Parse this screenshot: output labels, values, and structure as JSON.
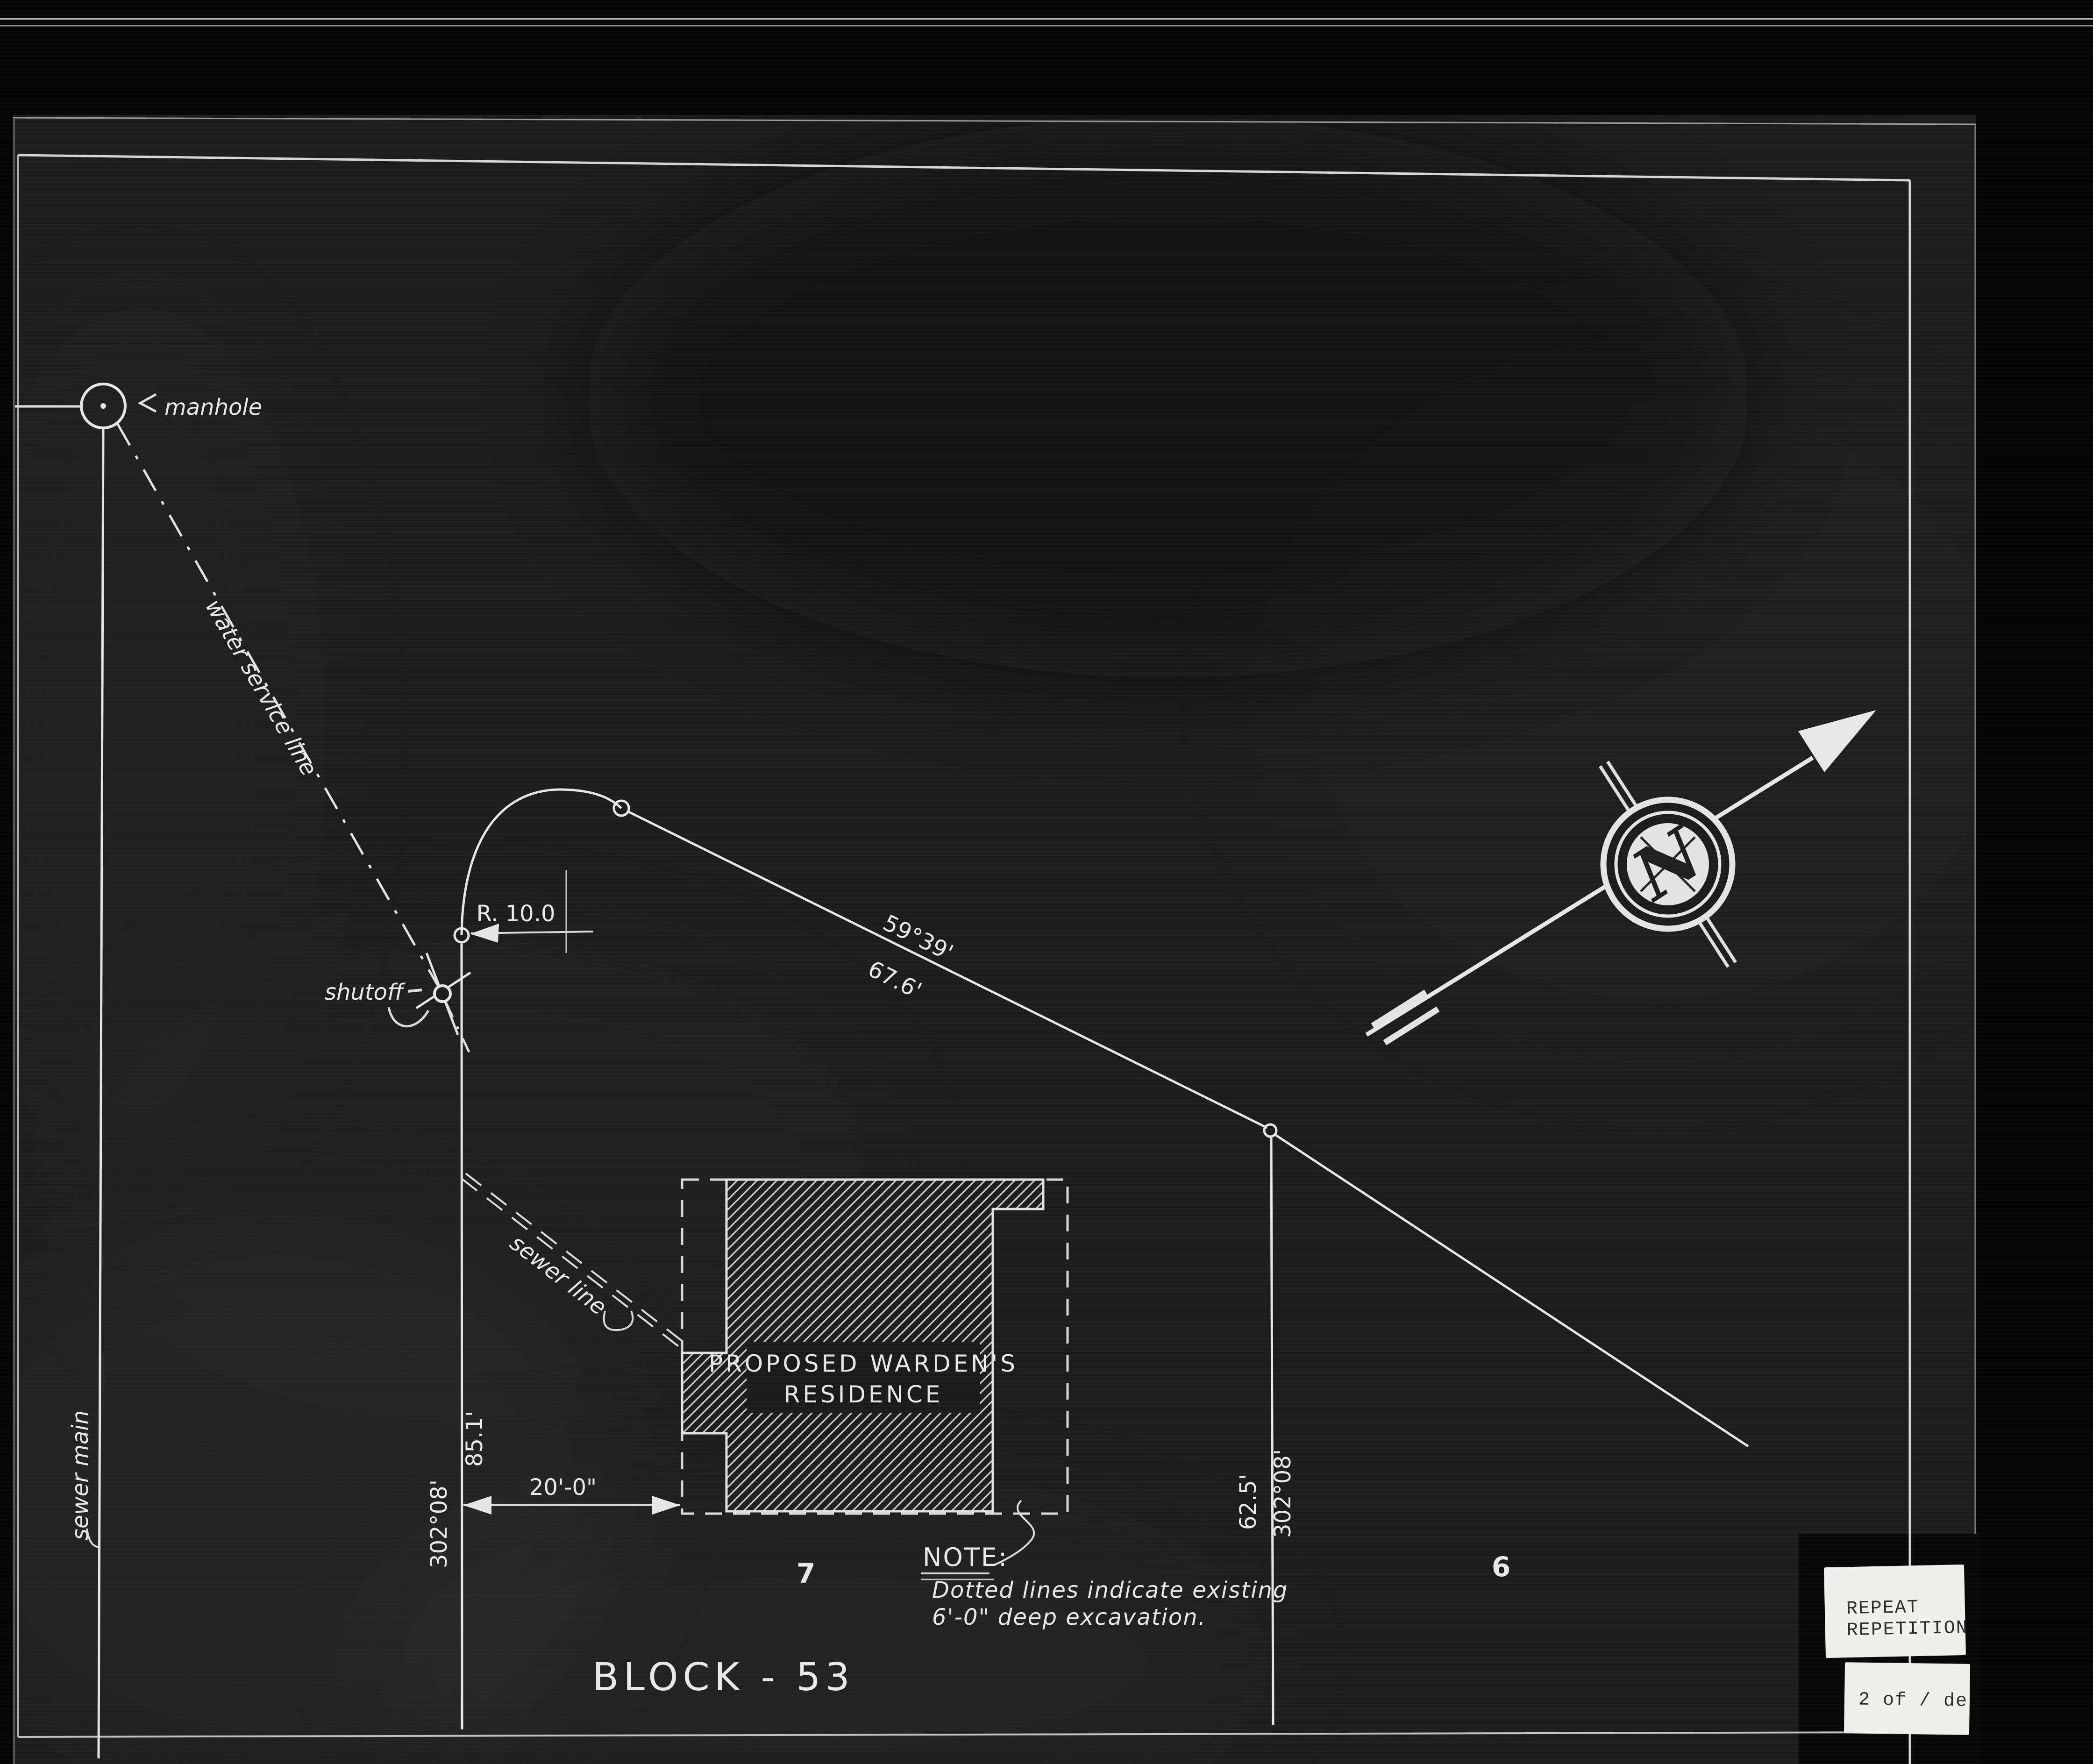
{
  "canvas": {
    "bg": "#060606",
    "sheet": "#1d1d1d",
    "ink": "#e6e6e6"
  },
  "annotations": {
    "manhole": "manhole",
    "water_service_line": "water service line",
    "shutoff": "shutoff",
    "sewer_main": "sewer main",
    "sewer_line": "sewer line"
  },
  "dimensions": {
    "curve_radius": "R. 10.0",
    "north_line_bearing": "59°39'",
    "north_line_length": "67.6'",
    "west_line_length": "85.1'",
    "west_line_bearing": "302°08'",
    "setback": "20'-0\"",
    "east_line_length": "62.5'",
    "east_line_bearing": "302°08'"
  },
  "building": {
    "label_line1": "PROPOSED WARDEN'S",
    "label_line2": "RESIDENCE"
  },
  "note": {
    "title": "NOTE:",
    "line1": "Dotted lines indicate existing",
    "line2": "6'-0\" deep excavation."
  },
  "lots": {
    "left": "7",
    "right": "6"
  },
  "block_title": "BLOCK - 53",
  "compass": {
    "letter": "N"
  },
  "stamps": {
    "repeat_line1": "REPEAT",
    "repeat_line2": "REPETITION",
    "page": "2 of / de"
  }
}
